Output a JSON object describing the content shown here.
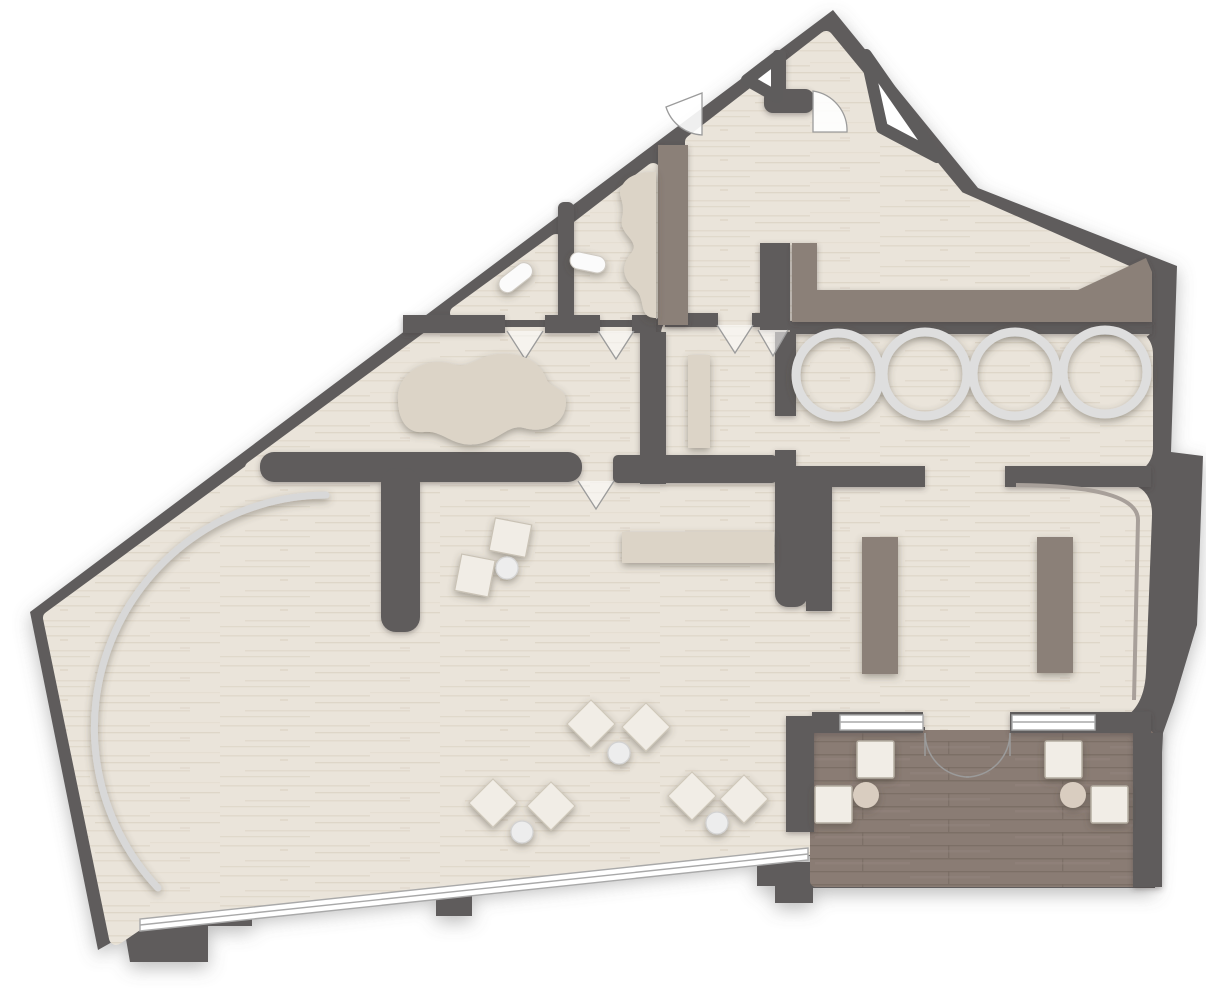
{
  "meta": {
    "type": "architectural-floor-plan",
    "view": "top-down rendered plan",
    "visible_text": []
  },
  "colors": {
    "wall": "#5e5c5c",
    "outside": "#ffffff",
    "floor_base": "#eae4da",
    "floor_streak_1": "#d9cfc0",
    "floor_streak_2": "#d2c7b5",
    "floor_streak_3": "#e0d7c9",
    "beige_furniture": "#dcd4c7",
    "taupe_furniture": "#8b8078",
    "deck_base": "#8a7c74",
    "deck_plank_dark": "#786b63",
    "deck_plank_light": "#958780",
    "seat_white": "#f1ede6",
    "seat_border": "#b4ada1",
    "ring": "#dedede",
    "arc_screen": "#d8d8d8",
    "glass": "#ffffff",
    "glass_line": "#a9a9a9",
    "door_line": "#9b9b9b",
    "door_fill": "#ffffff",
    "table_beige": "#d9cdc0",
    "side_table_white": "#ededed",
    "toilet_white": "#fbfbfb",
    "trim_line": "#a8a09a"
  },
  "rooms": [
    {
      "id": "main-hall",
      "label": "main hall"
    },
    {
      "id": "attic-room",
      "label": "peaked attic room"
    },
    {
      "id": "wc-1",
      "label": "wc room 1"
    },
    {
      "id": "wc-2",
      "label": "wc room 2"
    },
    {
      "id": "treatment-room",
      "label": "treatment room with organic platform"
    },
    {
      "id": "bench-room",
      "label": "small bench room"
    },
    {
      "id": "tub-room",
      "label": "soaking tub room"
    },
    {
      "id": "lounge-room",
      "label": "lounge room with two benches"
    },
    {
      "id": "deck",
      "label": "outdoor wood deck"
    }
  ],
  "fixtures": {
    "soaking_tubs": 4,
    "lounger_pairs_with_side_table": 3,
    "tilted_seat_pair_with_table": 1,
    "long_bench": 1,
    "small_bench": 1,
    "lounge_benches": 2,
    "deck_armchairs": 4,
    "deck_side_tables": 2,
    "toilets": 2,
    "organic_platforms": 2,
    "taupe_counter": 1,
    "curved_screen": 1,
    "door_swings": 2,
    "door_opening_markers": 5,
    "window_bands": 3,
    "french_doors": 1,
    "roof_struts": 2
  }
}
